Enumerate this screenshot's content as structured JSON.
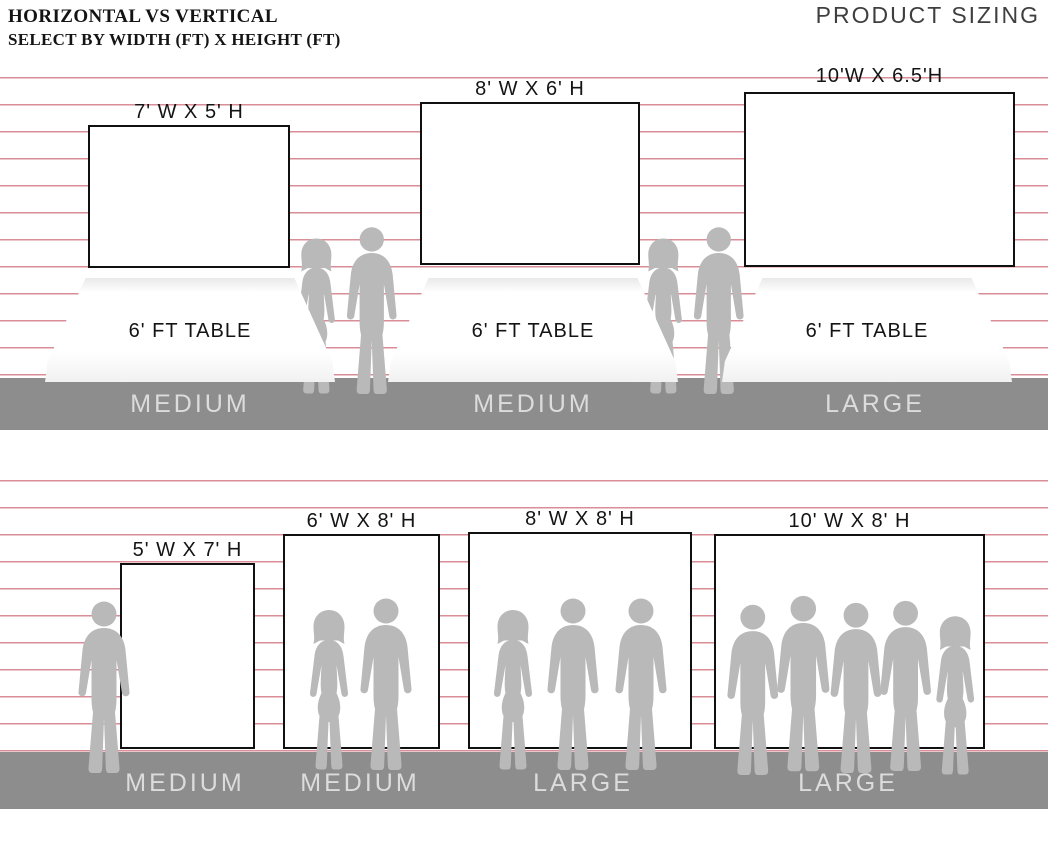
{
  "header": {
    "title_line1": "HORIZONTAL VS VERTICAL",
    "title_line2": "SELECT BY WIDTH (FT) X HEIGHT (FT)",
    "brand": "PRODUCT SIZING"
  },
  "colors": {
    "stripe": "#d98d96",
    "floor": "#8d8d8d",
    "silhouette": "#b9b9b9",
    "floor_label": "#dcdcdc",
    "ink": "#141414",
    "background": "#ffffff"
  },
  "horizontal_row": {
    "items": [
      {
        "size_label": "7' W X 5' H",
        "table_label": "6' FT TABLE",
        "category": "MEDIUM"
      },
      {
        "size_label": "8' W X 6' H",
        "table_label": "6' FT TABLE",
        "category": "MEDIUM"
      },
      {
        "size_label": "10'W X 6.5'H",
        "table_label": "6' FT TABLE",
        "category": "LARGE"
      }
    ]
  },
  "vertical_row": {
    "items": [
      {
        "size_label": "5' W X 7' H",
        "category": "MEDIUM"
      },
      {
        "size_label": "6' W X 8' H",
        "category": "MEDIUM"
      },
      {
        "size_label": "8' W X 8' H",
        "category": "LARGE"
      },
      {
        "size_label": "10' W X 8' H",
        "category": "LARGE"
      }
    ]
  }
}
